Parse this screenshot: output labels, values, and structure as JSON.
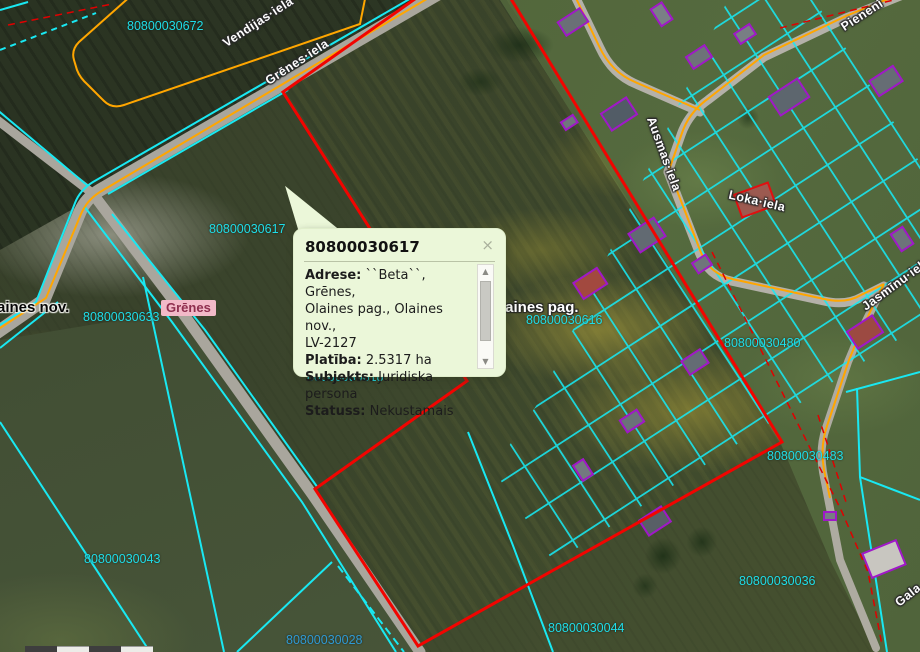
{
  "map": {
    "parcels": [
      {
        "id": "80800030672"
      },
      {
        "id": "80800030617"
      },
      {
        "id": "80800030633"
      },
      {
        "id": "80800030616"
      },
      {
        "id": "80800030618"
      },
      {
        "id": "80800030480"
      },
      {
        "id": "80800030483"
      },
      {
        "id": "80800030043"
      },
      {
        "id": "80800030036"
      },
      {
        "id": "80800030044"
      },
      {
        "id": "80800030028"
      }
    ],
    "streets": [
      {
        "name": "Vendijas·iela"
      },
      {
        "name": "Grēnes·iela"
      },
      {
        "name": "Ausmas·iela"
      },
      {
        "name": "Loka·iela"
      },
      {
        "name": "Jasmīnu·iela"
      },
      {
        "name": "Pienenī"
      },
      {
        "name": "Gala"
      }
    ],
    "places": {
      "municipality": "aines nov.",
      "parish": "laines pag.",
      "village": "Grēnes"
    }
  },
  "popup": {
    "title": "80800030617",
    "close": "×",
    "scroll_up": "▲",
    "scroll_down": "▼",
    "lines": [
      {
        "b": "Adrese:",
        "t": " ``Beta``, Grēnes,"
      },
      {
        "b": "",
        "t": "Olaines pag., Olaines nov.,"
      },
      {
        "b": "",
        "t": "LV-2127"
      },
      {
        "b": "Platība:",
        "t": " 2.5317 ha"
      },
      {
        "b": "Subjekts:",
        "t": " Juridiska"
      },
      {
        "b": "",
        "t": "persona"
      },
      {
        "b": "Statuss:",
        "t": " Nekustamais"
      }
    ]
  },
  "colors": {
    "parcel_line": "#19e8f2",
    "road_centerline": "#ffa600",
    "selected_boundary": "#f20400",
    "building_outline": "#a018c8",
    "parcel_label": "#1fdde8",
    "parcel_label_alt": "#2f9ad4",
    "popup_bg": "#ebf7d9"
  }
}
